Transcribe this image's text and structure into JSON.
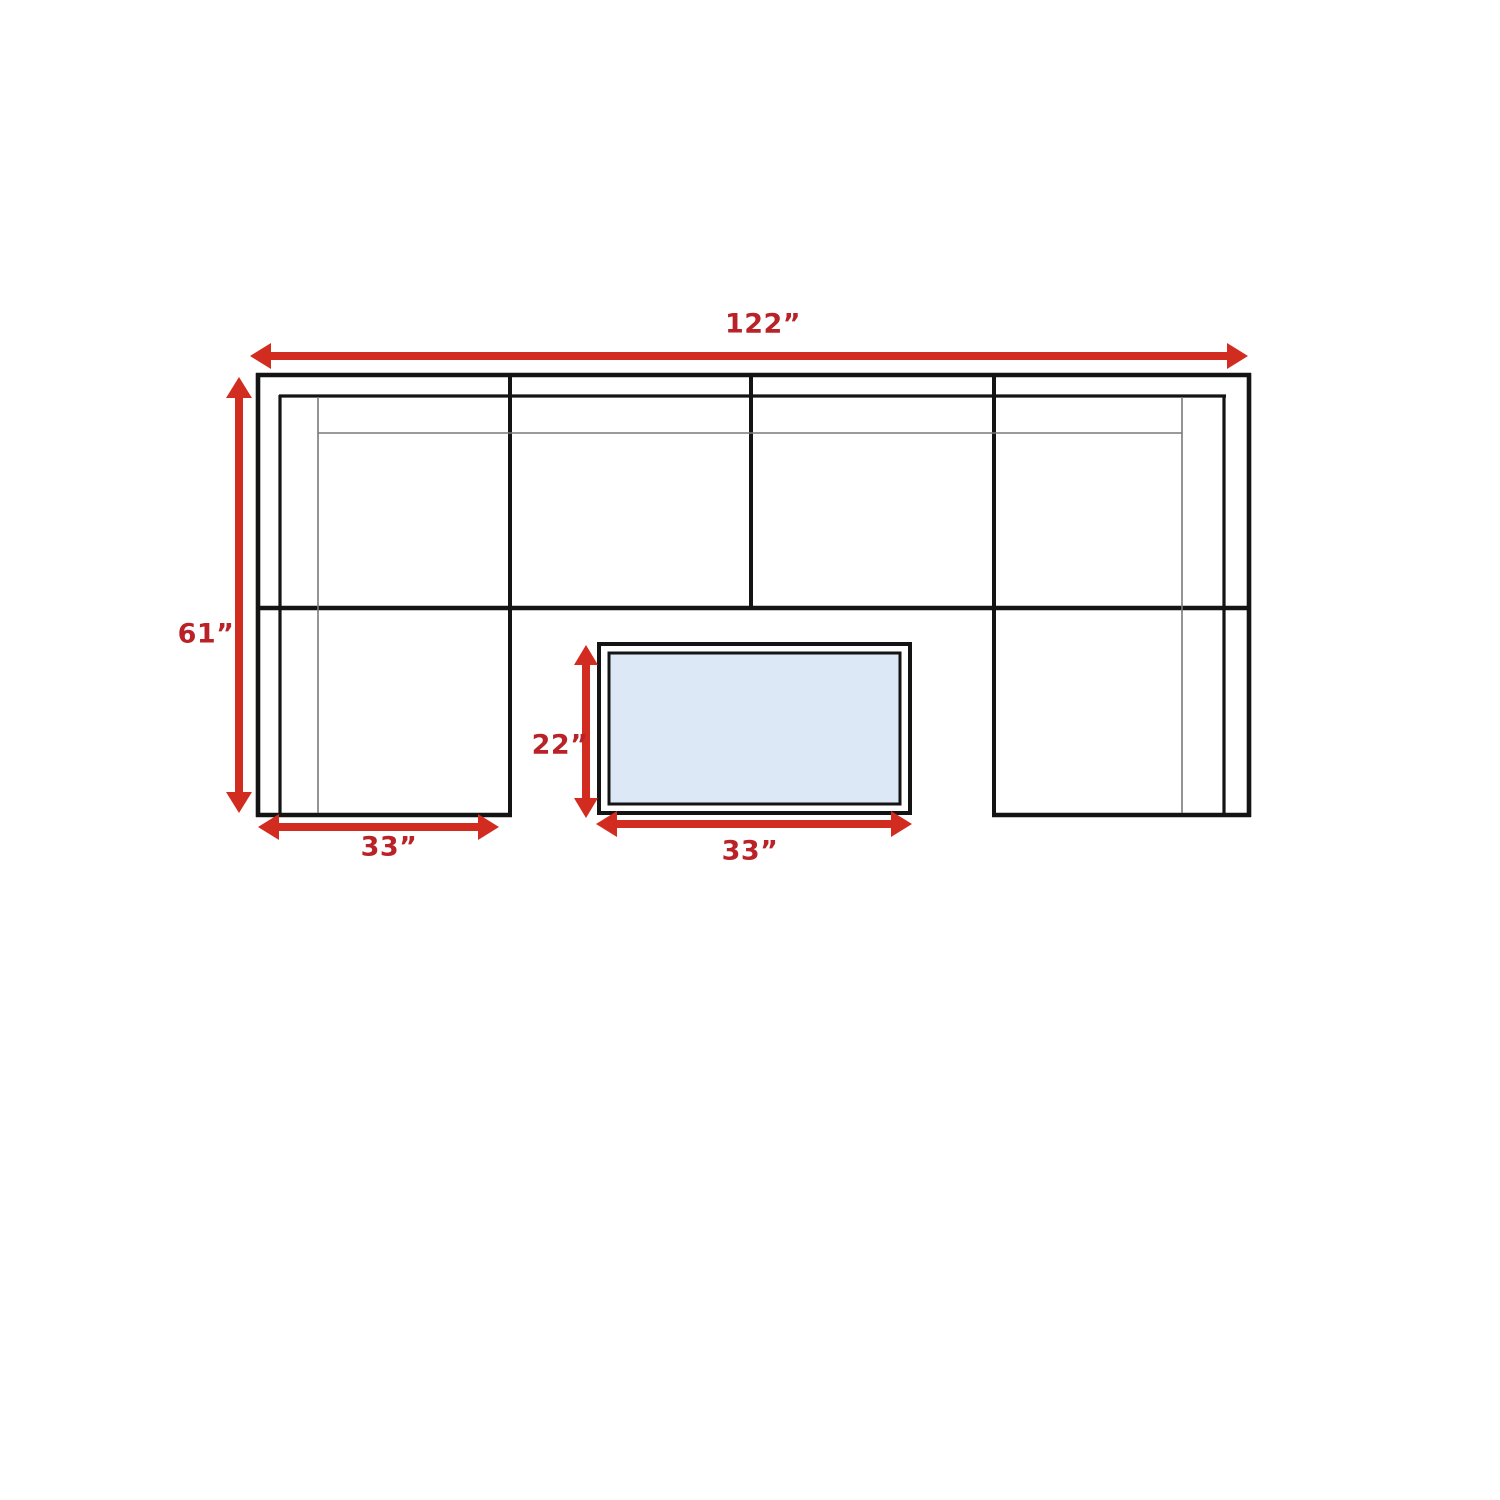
{
  "diagram": {
    "type": "furniture-floorplan",
    "subject": "u-shaped-sectional-sofa-with-coffee-table-top-view",
    "unit": "inches",
    "dimensions": {
      "overall_width": "122”",
      "overall_depth": "61”",
      "left_chaise_width": "33”",
      "table_depth": "22”",
      "table_width": "33”"
    },
    "colors": {
      "background": "#ffffff",
      "line": "#141414",
      "thin_line": "#7a7a7a",
      "arrow": "#d22b20",
      "label": "#b92328",
      "table_fill": "#dce8f6"
    }
  }
}
